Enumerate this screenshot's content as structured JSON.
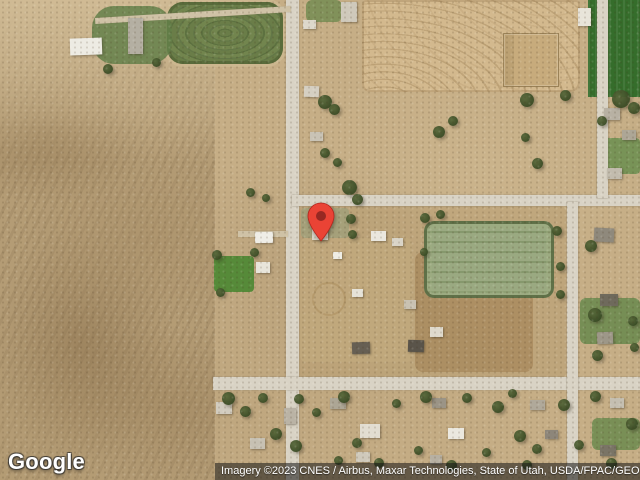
{
  "map": {
    "provider": "Google",
    "view": "satellite",
    "google_logo_text": "Google",
    "attribution_text": "Imagery ©2023 CNES / Airbus, Maxar Technologies, State of Utah, USDA/FPAC/GEO",
    "marker": {
      "x": 321,
      "y": 242,
      "color": "#EA4335",
      "stroke_color": "#B3261E",
      "inner_color": "#8E2620"
    },
    "palette": {
      "terrain_tan": "#c6ae86",
      "desert_scrub": "#b49c75",
      "road_paved": "#d9d3c5",
      "road_dirt": "#cfc2a6",
      "crop_dark_green": "#356d2b",
      "crop_contour_green": "#6a7d48",
      "sports_turf": "#9aa981",
      "plowed_tan": "#d3b98e",
      "tree_green": "#394a24",
      "lawn_green": "#568a39",
      "attribution_bg": "rgba(20,20,20,0.55)"
    },
    "features": [
      {
        "n": "desert-scrubland",
        "c": "desert",
        "x": 0,
        "y": 0,
        "w": 215,
        "h": 480
      },
      {
        "n": "desert-light-area",
        "c": "desert-top",
        "x": 0,
        "y": 0,
        "w": 215,
        "h": 160
      },
      {
        "n": "dirt-block-central",
        "c": "dirt",
        "x": 299,
        "y": 206,
        "w": 267,
        "h": 172,
        "bg": "#b89e73",
        "o": 0.55
      },
      {
        "n": "hay-paddock",
        "c": "dirt",
        "x": 415,
        "y": 252,
        "w": 118,
        "h": 120,
        "bg": "#a5865a",
        "o": 0.7,
        "r": 8
      },
      {
        "n": "farmyard-dirt",
        "c": "dirt",
        "x": 300,
        "y": 238,
        "w": 112,
        "h": 124,
        "bg": "#c2a97e",
        "o": 0.75,
        "r": 6
      },
      {
        "n": "contour-crop-field",
        "c": "f-contour",
        "x": 167,
        "y": 2,
        "w": 116,
        "h": 62,
        "r": 16
      },
      {
        "n": "plowed-field",
        "c": "f-plow",
        "x": 362,
        "y": 0,
        "w": 218,
        "h": 92
      },
      {
        "n": "dark-green-crop-field",
        "c": "f-darkgreen",
        "x": 588,
        "y": 0,
        "w": 52,
        "h": 97
      },
      {
        "n": "green-patch-topleft",
        "c": "lawn",
        "x": 92,
        "y": 6,
        "w": 80,
        "h": 58,
        "bg": "#64804a",
        "r": 22,
        "o": 0.85
      },
      {
        "n": "lawn-top-road",
        "c": "lawn",
        "x": 306,
        "y": 0,
        "w": 36,
        "h": 22,
        "bg": "#6f8a4f",
        "o": 0.8,
        "r": 6
      },
      {
        "n": "pin-block-grass",
        "c": "lawn",
        "x": 301,
        "y": 208,
        "w": 48,
        "h": 30,
        "bg": "#9aa07b",
        "o": 0.65,
        "r": 4
      },
      {
        "n": "lawn-house-west",
        "c": "lawn",
        "x": 214,
        "y": 256,
        "w": 40,
        "h": 36,
        "bg": "#568a39",
        "r": 4
      },
      {
        "n": "lawn-right-top",
        "c": "lawn",
        "x": 602,
        "y": 138,
        "w": 38,
        "h": 36,
        "bg": "#6f9052",
        "r": 4,
        "o": 0.9
      },
      {
        "n": "lawn-right-mid",
        "c": "lawn",
        "x": 580,
        "y": 298,
        "w": 60,
        "h": 46,
        "bg": "#6d8b50",
        "r": 6,
        "o": 0.9
      },
      {
        "n": "lawn-bottom-right",
        "c": "lawn",
        "x": 592,
        "y": 418,
        "w": 48,
        "h": 32,
        "bg": "#6b8a4e",
        "r": 6,
        "o": 0.85
      },
      {
        "n": "corral-pen",
        "c": "pen",
        "x": 503,
        "y": 33,
        "w": 54,
        "h": 52
      },
      {
        "n": "sports-field",
        "c": "f-sport",
        "x": 424,
        "y": 221,
        "w": 130,
        "h": 77,
        "r": 10
      },
      {
        "n": "round-pen",
        "c": "circ",
        "x": 312,
        "y": 282,
        "w": 30,
        "h": 30
      },
      {
        "n": "road-north-south-main",
        "c": "road",
        "x": 286,
        "y": 0,
        "w": 13,
        "h": 480
      },
      {
        "n": "road-east-west-north",
        "c": "road",
        "x": 292,
        "y": 195,
        "w": 348,
        "h": 11
      },
      {
        "n": "road-east-west-south",
        "c": "road",
        "x": 213,
        "y": 377,
        "w": 427,
        "h": 13
      },
      {
        "n": "road-north-south-east",
        "c": "road",
        "x": 567,
        "y": 202,
        "w": 11,
        "h": 278
      },
      {
        "n": "road-right-edge",
        "c": "road",
        "x": 597,
        "y": 0,
        "w": 11,
        "h": 198
      },
      {
        "n": "dirt-road-top",
        "c": "road-dirt",
        "x": 95,
        "y": 12,
        "w": 196,
        "h": 6,
        "rot": -3.5
      },
      {
        "n": "farm-driveway",
        "c": "road-dirt",
        "x": 238,
        "y": 231,
        "w": 50,
        "h": 6
      },
      {
        "n": "building",
        "c": "bld",
        "x": 341,
        "y": 2,
        "w": 16,
        "h": 20,
        "bg": "#cfc9bb"
      },
      {
        "n": "building",
        "c": "bld",
        "x": 303,
        "y": 20,
        "w": 13,
        "h": 9,
        "bg": "#ddd8cb"
      },
      {
        "n": "building",
        "c": "bld",
        "x": 304,
        "y": 86,
        "w": 15,
        "h": 11,
        "bg": "#d5cfc2",
        "rot": 2
      },
      {
        "n": "building",
        "c": "bld",
        "x": 310,
        "y": 132,
        "w": 13,
        "h": 9,
        "bg": "#c9c3b5"
      },
      {
        "n": "barn-white",
        "c": "bld",
        "x": 70,
        "y": 38,
        "w": 32,
        "h": 17,
        "bg": "#edebe3",
        "rot": -2
      },
      {
        "n": "barn-gray",
        "c": "bld",
        "x": 128,
        "y": 18,
        "w": 15,
        "h": 36,
        "bg": "#b4afa2"
      },
      {
        "n": "building",
        "c": "bld",
        "x": 578,
        "y": 8,
        "w": 13,
        "h": 18,
        "bg": "#e8e4d9"
      },
      {
        "n": "building",
        "c": "bld",
        "x": 604,
        "y": 108,
        "w": 16,
        "h": 12,
        "bg": "#b8b1a3"
      },
      {
        "n": "building",
        "c": "bld",
        "x": 622,
        "y": 130,
        "w": 14,
        "h": 10,
        "bg": "#ada696"
      },
      {
        "n": "building",
        "c": "bld",
        "x": 607,
        "y": 168,
        "w": 15,
        "h": 11,
        "bg": "#c2bcae"
      },
      {
        "n": "house-at-pin",
        "c": "bld",
        "x": 312,
        "y": 228,
        "w": 16,
        "h": 12,
        "bg": "#d8d3c6"
      },
      {
        "n": "building",
        "c": "bld",
        "x": 255,
        "y": 232,
        "w": 18,
        "h": 11,
        "bg": "#efede6",
        "rot": -1
      },
      {
        "n": "building",
        "c": "bld",
        "x": 256,
        "y": 262,
        "w": 14,
        "h": 11,
        "bg": "#e8e5da"
      },
      {
        "n": "building",
        "c": "bld",
        "x": 371,
        "y": 231,
        "w": 15,
        "h": 10,
        "bg": "#eae7de"
      },
      {
        "n": "building",
        "c": "bld",
        "x": 392,
        "y": 238,
        "w": 11,
        "h": 8,
        "bg": "#d9d4c7"
      },
      {
        "n": "building",
        "c": "bld",
        "x": 333,
        "y": 252,
        "w": 9,
        "h": 7,
        "bg": "#efede5"
      },
      {
        "n": "building",
        "c": "bld",
        "x": 352,
        "y": 289,
        "w": 11,
        "h": 8,
        "bg": "#e5e2d8"
      },
      {
        "n": "building",
        "c": "bld",
        "x": 404,
        "y": 300,
        "w": 12,
        "h": 9,
        "bg": "#c9c2b2"
      },
      {
        "n": "building",
        "c": "bld",
        "x": 430,
        "y": 327,
        "w": 13,
        "h": 10,
        "bg": "#dfdacd"
      },
      {
        "n": "building",
        "c": "bld",
        "x": 408,
        "y": 340,
        "w": 16,
        "h": 12,
        "bg": "#5a544a",
        "rot": 2
      },
      {
        "n": "building",
        "c": "bld",
        "x": 352,
        "y": 342,
        "w": 18,
        "h": 12,
        "bg": "#665f53",
        "rot": -2
      },
      {
        "n": "building",
        "c": "bld",
        "x": 594,
        "y": 228,
        "w": 20,
        "h": 14,
        "bg": "#8f897c",
        "rot": 3
      },
      {
        "n": "building",
        "c": "bld",
        "x": 600,
        "y": 294,
        "w": 18,
        "h": 12,
        "bg": "#6f6a5c"
      },
      {
        "n": "building",
        "c": "bld",
        "x": 597,
        "y": 332,
        "w": 16,
        "h": 12,
        "bg": "#9d9788",
        "rot": -2
      },
      {
        "n": "building",
        "c": "bld",
        "x": 216,
        "y": 402,
        "w": 16,
        "h": 12,
        "bg": "#d2ccbf"
      },
      {
        "n": "building",
        "c": "bld",
        "x": 250,
        "y": 438,
        "w": 15,
        "h": 11,
        "bg": "#c7c1b3"
      },
      {
        "n": "building",
        "c": "bld",
        "x": 284,
        "y": 408,
        "w": 12,
        "h": 16,
        "bg": "#bab3a5"
      },
      {
        "n": "building",
        "c": "bld",
        "x": 330,
        "y": 398,
        "w": 16,
        "h": 11,
        "bg": "#ada695"
      },
      {
        "n": "building",
        "c": "bld",
        "x": 360,
        "y": 424,
        "w": 20,
        "h": 14,
        "bg": "#e2ddd1"
      },
      {
        "n": "building",
        "c": "bld",
        "x": 432,
        "y": 398,
        "w": 14,
        "h": 10,
        "bg": "#9b9486"
      },
      {
        "n": "building",
        "c": "bld",
        "x": 448,
        "y": 428,
        "w": 16,
        "h": 11,
        "bg": "#ebe8df"
      },
      {
        "n": "building",
        "c": "bld",
        "x": 530,
        "y": 400,
        "w": 15,
        "h": 10,
        "bg": "#b0a99a"
      },
      {
        "n": "building",
        "c": "bld",
        "x": 545,
        "y": 430,
        "w": 13,
        "h": 9,
        "bg": "#8d867a"
      },
      {
        "n": "building",
        "c": "bld",
        "x": 610,
        "y": 398,
        "w": 14,
        "h": 10,
        "bg": "#c5bfb1"
      },
      {
        "n": "building",
        "c": "bld",
        "x": 600,
        "y": 445,
        "w": 16,
        "h": 11,
        "bg": "#7a7466"
      },
      {
        "n": "building",
        "c": "bld",
        "x": 356,
        "y": 452,
        "w": 14,
        "h": 10,
        "bg": "#cfc9bb"
      },
      {
        "n": "building",
        "c": "bld",
        "x": 430,
        "y": 455,
        "w": 12,
        "h": 9,
        "bg": "#b7b0a2"
      },
      {
        "n": "tree",
        "c": "tree",
        "x": 318,
        "y": 95,
        "s": 14
      },
      {
        "n": "tree",
        "c": "tree",
        "x": 329,
        "y": 104,
        "s": 11
      },
      {
        "n": "tree",
        "c": "tree",
        "x": 320,
        "y": 148,
        "s": 10
      },
      {
        "n": "tree",
        "c": "tree",
        "x": 333,
        "y": 158,
        "s": 9
      },
      {
        "n": "tree",
        "c": "tree",
        "x": 342,
        "y": 180,
        "s": 15
      },
      {
        "n": "tree",
        "c": "tree",
        "x": 352,
        "y": 194,
        "s": 11
      },
      {
        "n": "tree",
        "c": "tree",
        "x": 346,
        "y": 214,
        "s": 10
      },
      {
        "n": "tree",
        "c": "tree",
        "x": 348,
        "y": 230,
        "s": 9
      },
      {
        "n": "tree",
        "c": "tree",
        "x": 433,
        "y": 126,
        "s": 12
      },
      {
        "n": "tree",
        "c": "tree",
        "x": 448,
        "y": 116,
        "s": 10
      },
      {
        "n": "tree",
        "c": "tree",
        "x": 520,
        "y": 93,
        "s": 14
      },
      {
        "n": "tree",
        "c": "tree",
        "x": 532,
        "y": 158,
        "s": 11
      },
      {
        "n": "tree",
        "c": "tree",
        "x": 560,
        "y": 90,
        "s": 11
      },
      {
        "n": "tree",
        "c": "tree",
        "x": 521,
        "y": 133,
        "s": 9
      },
      {
        "n": "tree",
        "c": "tree",
        "x": 612,
        "y": 90,
        "s": 18
      },
      {
        "n": "tree",
        "c": "tree",
        "x": 628,
        "y": 102,
        "s": 12
      },
      {
        "n": "tree",
        "c": "tree",
        "x": 597,
        "y": 116,
        "s": 10
      },
      {
        "n": "tree",
        "c": "tree",
        "x": 420,
        "y": 213,
        "s": 10
      },
      {
        "n": "tree",
        "c": "tree",
        "x": 436,
        "y": 210,
        "s": 9
      },
      {
        "n": "tree",
        "c": "tree",
        "x": 552,
        "y": 226,
        "s": 10
      },
      {
        "n": "tree",
        "c": "tree",
        "x": 556,
        "y": 262,
        "s": 9
      },
      {
        "n": "tree",
        "c": "tree",
        "x": 556,
        "y": 290,
        "s": 9
      },
      {
        "n": "tree",
        "c": "tree",
        "x": 420,
        "y": 248,
        "s": 8
      },
      {
        "n": "tree",
        "c": "tree",
        "x": 585,
        "y": 240,
        "s": 12
      },
      {
        "n": "tree",
        "c": "tree",
        "x": 588,
        "y": 308,
        "s": 14
      },
      {
        "n": "tree",
        "c": "tree",
        "x": 628,
        "y": 316,
        "s": 10
      },
      {
        "n": "tree",
        "c": "tree",
        "x": 592,
        "y": 350,
        "s": 11
      },
      {
        "n": "tree",
        "c": "tree",
        "x": 630,
        "y": 343,
        "s": 9
      },
      {
        "n": "tree",
        "c": "tree",
        "x": 246,
        "y": 188,
        "s": 9
      },
      {
        "n": "tree",
        "c": "tree",
        "x": 262,
        "y": 194,
        "s": 8
      },
      {
        "n": "tree",
        "c": "tree",
        "x": 212,
        "y": 250,
        "s": 10
      },
      {
        "n": "tree",
        "c": "tree",
        "x": 250,
        "y": 248,
        "s": 9
      },
      {
        "n": "tree",
        "c": "tree",
        "x": 216,
        "y": 288,
        "s": 9
      },
      {
        "n": "tree",
        "c": "tree",
        "x": 103,
        "y": 64,
        "s": 10
      },
      {
        "n": "tree",
        "c": "tree",
        "x": 152,
        "y": 58,
        "s": 9
      },
      {
        "n": "tree",
        "c": "tree",
        "x": 222,
        "y": 392,
        "s": 13
      },
      {
        "n": "tree",
        "c": "tree",
        "x": 240,
        "y": 406,
        "s": 11
      },
      {
        "n": "tree",
        "c": "tree",
        "x": 258,
        "y": 393,
        "s": 10
      },
      {
        "n": "tree",
        "c": "tree",
        "x": 270,
        "y": 428,
        "s": 12
      },
      {
        "n": "tree",
        "c": "tree",
        "x": 294,
        "y": 394,
        "s": 10
      },
      {
        "n": "tree",
        "c": "tree",
        "x": 290,
        "y": 440,
        "s": 12
      },
      {
        "n": "tree",
        "c": "tree",
        "x": 312,
        "y": 408,
        "s": 9
      },
      {
        "n": "tree",
        "c": "tree",
        "x": 338,
        "y": 391,
        "s": 12
      },
      {
        "n": "tree",
        "c": "tree",
        "x": 352,
        "y": 438,
        "s": 10
      },
      {
        "n": "tree",
        "c": "tree",
        "x": 392,
        "y": 399,
        "s": 9
      },
      {
        "n": "tree",
        "c": "tree",
        "x": 420,
        "y": 391,
        "s": 12
      },
      {
        "n": "tree",
        "c": "tree",
        "x": 462,
        "y": 393,
        "s": 10
      },
      {
        "n": "tree",
        "c": "tree",
        "x": 492,
        "y": 401,
        "s": 12
      },
      {
        "n": "tree",
        "c": "tree",
        "x": 508,
        "y": 389,
        "s": 9
      },
      {
        "n": "tree",
        "c": "tree",
        "x": 514,
        "y": 430,
        "s": 12
      },
      {
        "n": "tree",
        "c": "tree",
        "x": 532,
        "y": 444,
        "s": 10
      },
      {
        "n": "tree",
        "c": "tree",
        "x": 558,
        "y": 399,
        "s": 12
      },
      {
        "n": "tree",
        "c": "tree",
        "x": 574,
        "y": 440,
        "s": 10
      },
      {
        "n": "tree",
        "c": "tree",
        "x": 590,
        "y": 391,
        "s": 11
      },
      {
        "n": "tree",
        "c": "tree",
        "x": 626,
        "y": 418,
        "s": 12
      },
      {
        "n": "tree",
        "c": "tree",
        "x": 606,
        "y": 458,
        "s": 11
      },
      {
        "n": "tree",
        "c": "tree",
        "x": 522,
        "y": 460,
        "s": 10
      },
      {
        "n": "tree",
        "c": "tree",
        "x": 482,
        "y": 448,
        "s": 9
      },
      {
        "n": "tree",
        "c": "tree",
        "x": 446,
        "y": 460,
        "s": 11
      },
      {
        "n": "tree",
        "c": "tree",
        "x": 414,
        "y": 446,
        "s": 9
      },
      {
        "n": "tree",
        "c": "tree",
        "x": 374,
        "y": 458,
        "s": 10
      },
      {
        "n": "tree",
        "c": "tree",
        "x": 334,
        "y": 456,
        "s": 9
      }
    ]
  }
}
